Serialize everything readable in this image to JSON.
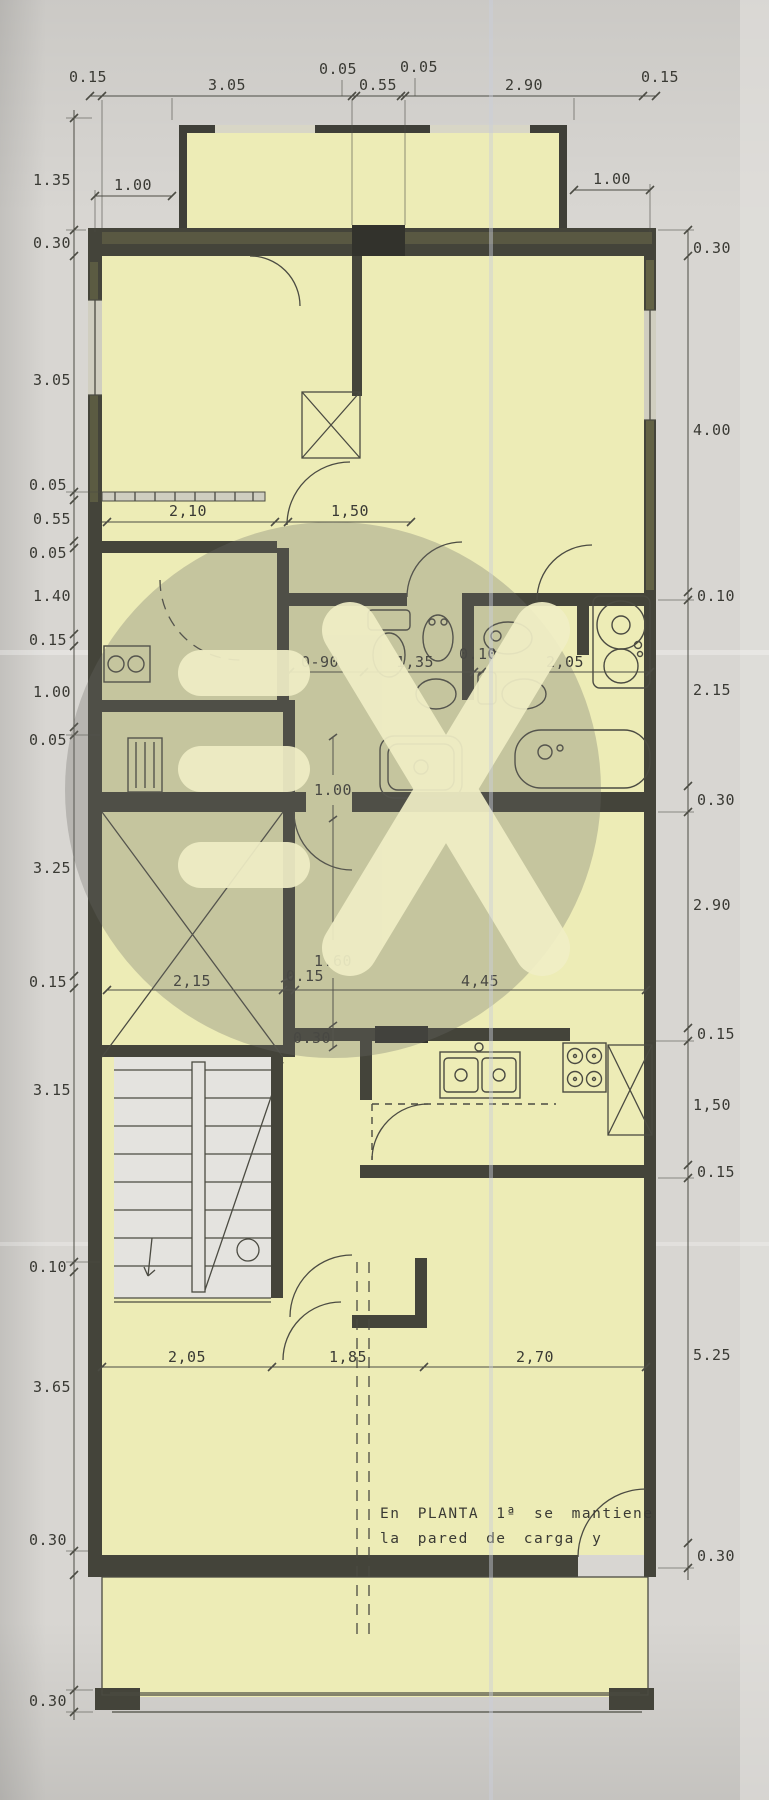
{
  "colors": {
    "paper": "#d8d6d2",
    "plan_highlight": "#edecb6",
    "wall_dark": "#44443a",
    "wall_olive": "#6b6a48",
    "line": "#4b4b42",
    "dim": "#4c4c44",
    "dim_text": "#3a3a34",
    "stair_fill": "#e4e3df",
    "watermark_gray": "#6b6b66",
    "watermark_glyph": "#f0eec6",
    "crease": "#c9cedb"
  },
  "note": {
    "line1": "En PLANTA 1ª se mantiene",
    "line2": "la pared de carga y"
  },
  "dims": {
    "top": [
      "0.15",
      "3.05",
      "0.05",
      "0.55",
      "0.05",
      "2.90",
      "0.15"
    ],
    "bay": [
      "1.00",
      "1.00"
    ],
    "left": [
      "1.35",
      "0.30",
      "3.05",
      "0.05",
      "0.55",
      "0.05",
      "1.40",
      "0.15",
      "1.00",
      "0.05",
      "3.25",
      "0.15",
      "3.15",
      "0.10",
      "3.65",
      "0.30",
      "0.30"
    ],
    "right": [
      "0.30",
      "4.00",
      "0.10",
      "2.15",
      "0.30",
      "2.90",
      "0.15",
      "1,50",
      "0.15",
      "5.25",
      "0.30"
    ],
    "hall": [
      "2,10",
      "1,50"
    ],
    "bath": [
      "0-90",
      "1,35",
      "0.10",
      "2,05"
    ],
    "mid": [
      "1.00",
      "1.60",
      "0.15",
      "2,15",
      "4,45",
      "0.30"
    ],
    "bottom": [
      "2,05",
      "1,85",
      "2,70"
    ]
  }
}
